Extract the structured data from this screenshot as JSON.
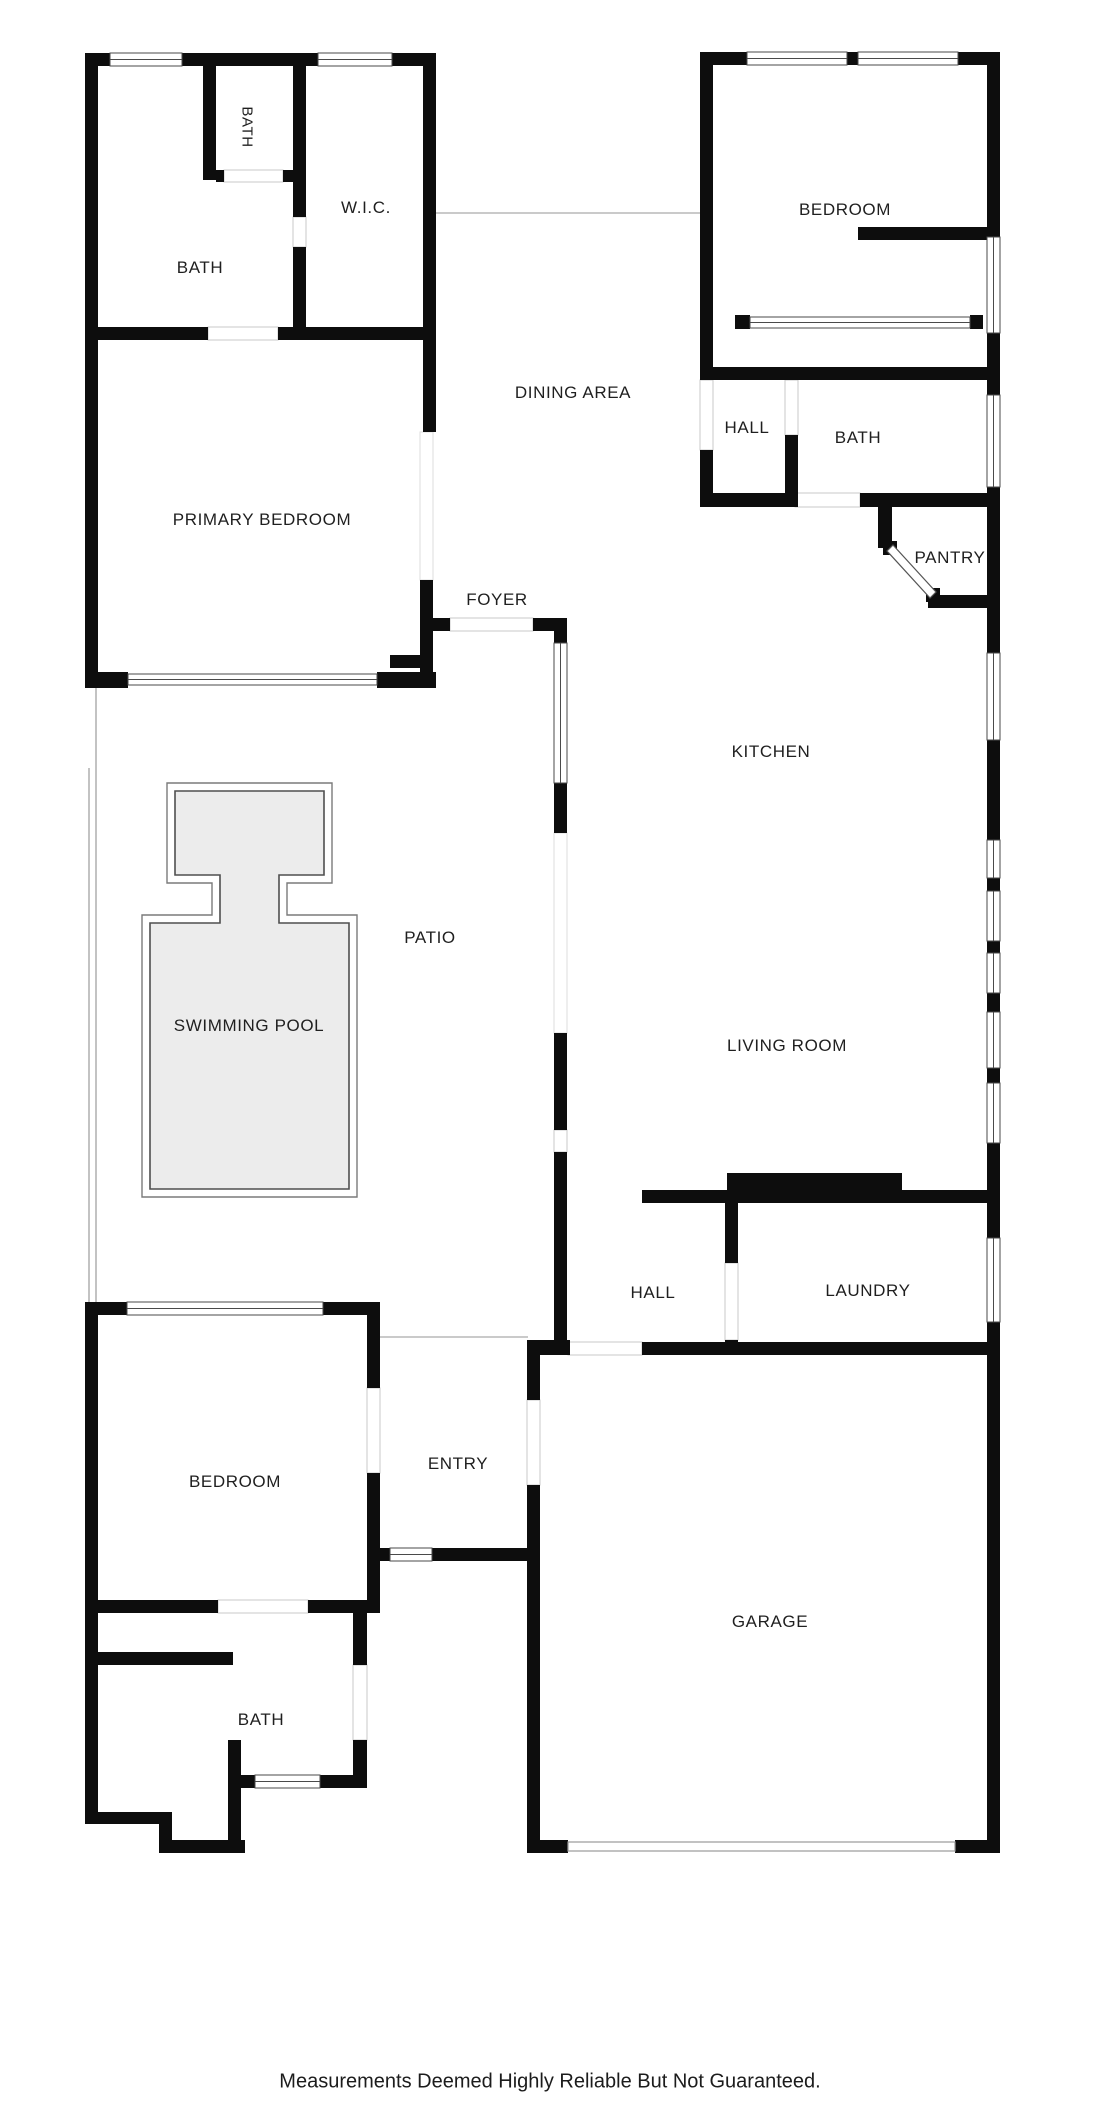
{
  "colors": {
    "wall": "#0d0d0d",
    "pool_fill": "#ececec",
    "line": "#4a4a4a",
    "label": "#1f1f1f"
  },
  "labels": {
    "bath_small": "BATH",
    "wic": "W.I.C.",
    "bath_upper": "BATH",
    "bedroom_top": "BEDROOM",
    "dining": "DINING AREA",
    "hall_upper": "HALL",
    "bath_right": "BATH",
    "primary_bedroom": "PRIMARY BEDROOM",
    "pantry": "PANTRY",
    "foyer": "FOYER",
    "kitchen": "KITCHEN",
    "patio": "PATIO",
    "swimming_pool": "SWIMMING POOL",
    "living_room": "LIVING ROOM",
    "hall_lower": "HALL",
    "laundry": "LAUNDRY",
    "bedroom_lower": "BEDROOM",
    "entry": "ENTRY",
    "garage": "GARAGE",
    "bath_lower": "BATH"
  },
  "disclaimer": "Measurements Deemed Highly Reliable But Not Guaranteed."
}
